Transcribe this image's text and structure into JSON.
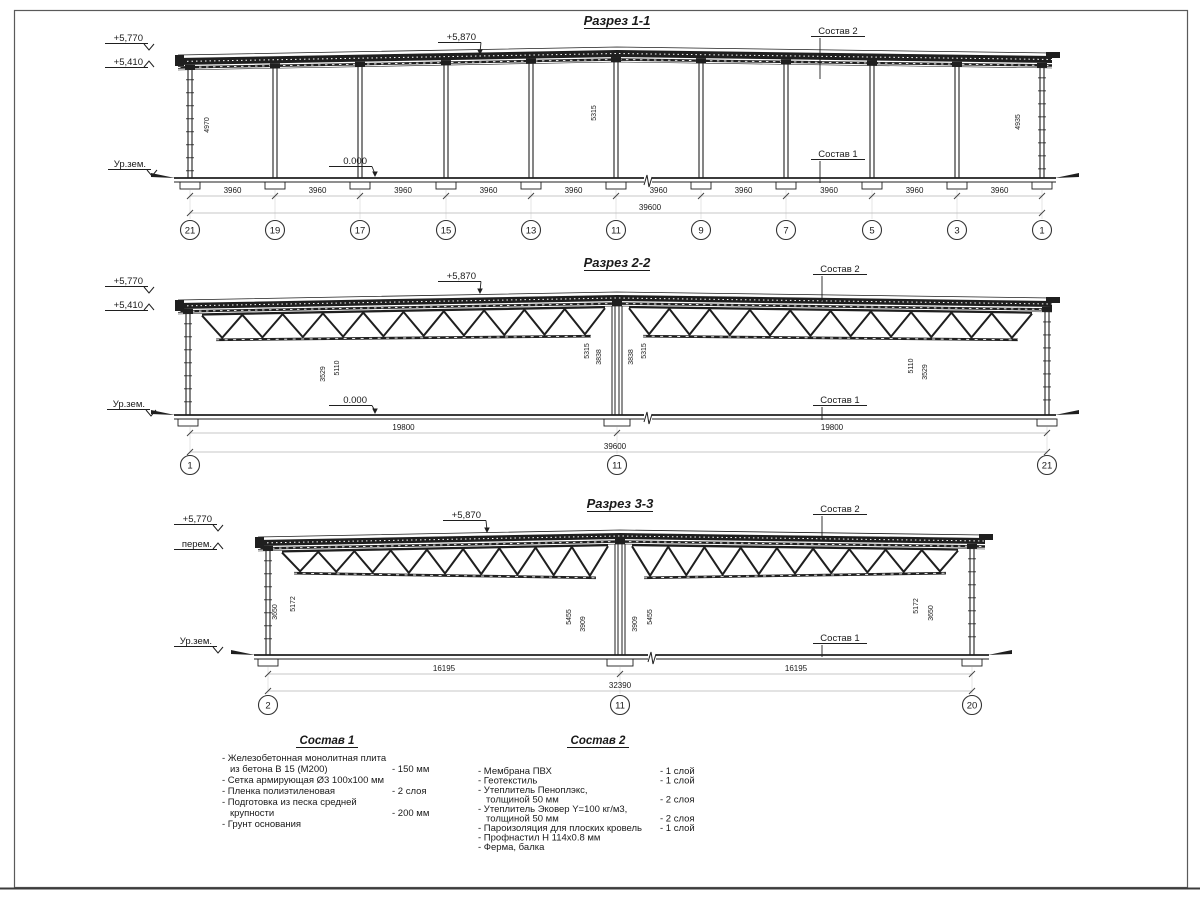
{
  "colors": {
    "ink": "#1f1f1f",
    "dim_label": "#c4c4c4",
    "dim_line": "#b5b5b5",
    "ext_line": "#dcdcdc",
    "faint": "#c9c9c9",
    "paper": "#ffffff",
    "border": "#4a4a4a"
  },
  "sections": [
    {
      "id": "1-1",
      "title": "Разрез 1-1",
      "roof": {
        "x1": 178,
        "x2": 1052,
        "y1": 58,
        "peak_x": 617,
        "peak_y": 50,
        "y2": 56,
        "t": 7
      },
      "floor_y": 178,
      "break_x": 648,
      "columns": [
        190,
        275,
        360,
        446,
        531,
        616,
        701,
        786,
        872,
        957,
        1042
      ],
      "trusses": [],
      "grid": {
        "xs": [
          190,
          275,
          360,
          446,
          531,
          616,
          701,
          786,
          872,
          957,
          1042
        ],
        "labels": [
          "21",
          "19",
          "17",
          "15",
          "13",
          "11",
          "9",
          "7",
          "5",
          "3",
          "1"
        ],
        "bays": [
          "3960",
          "3960",
          "3960",
          "3960",
          "3960",
          "3960",
          "3960",
          "3960",
          "3960",
          "3960"
        ],
        "overall": "39600",
        "overall_x": 650,
        "y1": 196,
        "y2": 213,
        "y_bub": 230
      },
      "levels": [
        {
          "text": "+5,770",
          "x": 143,
          "y": 41,
          "dir": "down"
        },
        {
          "text": "+5,410",
          "x": 143,
          "y": 65,
          "dir": "up"
        },
        {
          "text": "Ур.зем.",
          "x": 146,
          "y": 167,
          "dir": "down"
        },
        {
          "text": "0.000",
          "x": 367,
          "y": 164,
          "dir": "arrow",
          "ax": 375,
          "ay": 177
        },
        {
          "text": "+5,870",
          "x": 476,
          "y": 40,
          "dir": "arrow",
          "ax": 480,
          "ay": 55
        }
      ],
      "callouts": [
        {
          "text": "Состав 2",
          "x": 838,
          "y": 34,
          "lx": 820,
          "ly1": 38,
          "ly2": 79
        },
        {
          "text": "Состав 1",
          "x": 838,
          "y": 157,
          "lx": 820,
          "ly1": 161,
          "ly2": 183
        }
      ],
      "faint_dims": [
        {
          "text": "4970",
          "x": 209,
          "y": 125
        },
        {
          "text": "5315",
          "x": 596,
          "y": 113
        },
        {
          "text": "4935",
          "x": 1020,
          "y": 122
        }
      ]
    },
    {
      "id": "2-2",
      "title": "Разрез 2-2",
      "roof": {
        "x1": 178,
        "x2": 1052,
        "y1": 303,
        "peak_x": 617,
        "peak_y": 295,
        "y2": 301,
        "t": 6
      },
      "floor_y": 415,
      "break_x": 648,
      "columns": [
        188,
        617,
        1047
      ],
      "double_col": 617,
      "trusses": [
        {
          "x1": 202,
          "x2": 605,
          "bot": 340,
          "bot2": 336,
          "n": 10
        },
        {
          "x1": 629,
          "x2": 1032,
          "bot": 336,
          "bot2": 340,
          "n": 10
        }
      ],
      "grid": {
        "xs": [
          190,
          617,
          1047
        ],
        "labels": [
          "1",
          "11",
          "21"
        ],
        "bays": [
          "19800",
          "19800"
        ],
        "overall": "39600",
        "overall_x": 615,
        "y1": 433,
        "y2": 452,
        "y_bub": 465
      },
      "levels": [
        {
          "text": "+5,770",
          "x": 143,
          "y": 284,
          "dir": "down"
        },
        {
          "text": "+5,410",
          "x": 143,
          "y": 308,
          "dir": "up"
        },
        {
          "text": "Ур.зем.",
          "x": 145,
          "y": 407,
          "dir": "down"
        },
        {
          "text": "0.000",
          "x": 367,
          "y": 403,
          "dir": "arrow",
          "ax": 375,
          "ay": 414
        },
        {
          "text": "+5,870",
          "x": 476,
          "y": 279,
          "dir": "arrow",
          "ax": 480,
          "ay": 294
        }
      ],
      "callouts": [
        {
          "text": "Состав 2",
          "x": 840,
          "y": 272,
          "lx": 822,
          "ly1": 276,
          "ly2": 301
        },
        {
          "text": "Состав 1",
          "x": 840,
          "y": 403,
          "lx": 822,
          "ly1": 407,
          "ly2": 420
        }
      ],
      "faint_dims": [
        {
          "text": "3529",
          "x": 325,
          "y": 374
        },
        {
          "text": "5110",
          "x": 339,
          "y": 368
        },
        {
          "text": "5315",
          "x": 589,
          "y": 351
        },
        {
          "text": "3838",
          "x": 601,
          "y": 357
        },
        {
          "text": "3838",
          "x": 633,
          "y": 357
        },
        {
          "text": "5315",
          "x": 646,
          "y": 351
        },
        {
          "text": "5110",
          "x": 913,
          "y": 366
        },
        {
          "text": "3529",
          "x": 927,
          "y": 372
        }
      ]
    },
    {
      "id": "3-3",
      "title": "Разрез 3-3",
      "roof": {
        "x1": 258,
        "x2": 985,
        "y1": 540,
        "peak_x": 620,
        "peak_y": 533,
        "y2": 538,
        "t": 6
      },
      "floor_y": 655,
      "break_x": 652,
      "columns": [
        268,
        620,
        972
      ],
      "double_col": 620,
      "trusses": [
        {
          "x1": 282,
          "x2": 608,
          "bot": 573,
          "bot2": 578,
          "n": 9
        },
        {
          "x1": 632,
          "x2": 958,
          "bot": 578,
          "bot2": 573,
          "n": 9
        }
      ],
      "grid": {
        "xs": [
          268,
          620,
          972
        ],
        "labels": [
          "2",
          "11",
          "20"
        ],
        "bays": [
          "16195",
          "16195"
        ],
        "overall": "32390",
        "overall_x": 620,
        "y1": 674,
        "y2": 691,
        "y_bub": 705
      },
      "levels": [
        {
          "text": "+5,770",
          "x": 212,
          "y": 522,
          "dir": "down"
        },
        {
          "text": "перем.",
          "x": 212,
          "y": 547,
          "dir": "up"
        },
        {
          "text": "Ур.зем.",
          "x": 212,
          "y": 644,
          "dir": "down"
        },
        {
          "text": "+5,870",
          "x": 481,
          "y": 518,
          "dir": "arrow",
          "ax": 487,
          "ay": 533
        }
      ],
      "callouts": [
        {
          "text": "Состав 2",
          "x": 840,
          "y": 512,
          "lx": 822,
          "ly1": 516,
          "ly2": 539
        },
        {
          "text": "Состав 1",
          "x": 840,
          "y": 641,
          "lx": 822,
          "ly1": 645,
          "ly2": 657
        }
      ],
      "faint_dims": [
        {
          "text": "3650",
          "x": 277,
          "y": 612
        },
        {
          "text": "5172",
          "x": 295,
          "y": 604
        },
        {
          "text": "5455",
          "x": 571,
          "y": 617
        },
        {
          "text": "3909",
          "x": 585,
          "y": 624
        },
        {
          "text": "3909",
          "x": 637,
          "y": 624
        },
        {
          "text": "5455",
          "x": 652,
          "y": 617
        },
        {
          "text": "5172",
          "x": 918,
          "y": 606
        },
        {
          "text": "3650",
          "x": 933,
          "y": 613
        }
      ]
    }
  ],
  "legend": {
    "comp1": {
      "title": "Состав 1",
      "x": 327,
      "y": 744,
      "items_x": 222,
      "value_x": 392,
      "start_y": 761,
      "line_h": 11,
      "rows": [
        {
          "text": "- Железобетонная  монолитная плита",
          "value": ""
        },
        {
          "text": "из бетона В 15 (М200)",
          "value": "- 150 мм",
          "indent": true
        },
        {
          "text": "- Сетка армирующая Ø3 100х100 мм",
          "value": ""
        },
        {
          "text": "- Пленка полиэтиленовая",
          "value": "- 2 слоя"
        },
        {
          "text": "- Подготовка из песка средней",
          "value": ""
        },
        {
          "text": "крупности",
          "value": "- 200 мм",
          "indent": true
        },
        {
          "text": "- Грунт основания",
          "value": ""
        }
      ]
    },
    "comp2": {
      "title": "Состав 2",
      "x": 598,
      "y": 744,
      "items_x": 478,
      "value_x": 660,
      "start_y": 774,
      "line_h": 9.5,
      "rows": [
        {
          "text": "- Мембрана ПВХ",
          "value": "- 1 слой"
        },
        {
          "text": "- Геотекстиль",
          "value": "- 1 слой"
        },
        {
          "text": "- Утеплитель Пеноплэкс,",
          "value": ""
        },
        {
          "text": "толщиной 50 мм",
          "value": "- 2 слоя",
          "indent": true
        },
        {
          "text": "- Утеплитель Эковер Y=100 кг/м3,",
          "value": ""
        },
        {
          "text": "толщиной 50 мм",
          "value": "- 2 слоя",
          "indent": true
        },
        {
          "text": "- Пароизоляция для плоских кровель",
          "value": "- 1 слой"
        },
        {
          "text": "- Профнастил Н 114х0.8 мм",
          "value": ""
        },
        {
          "text": "- Ферма, балка",
          "value": ""
        }
      ]
    }
  }
}
